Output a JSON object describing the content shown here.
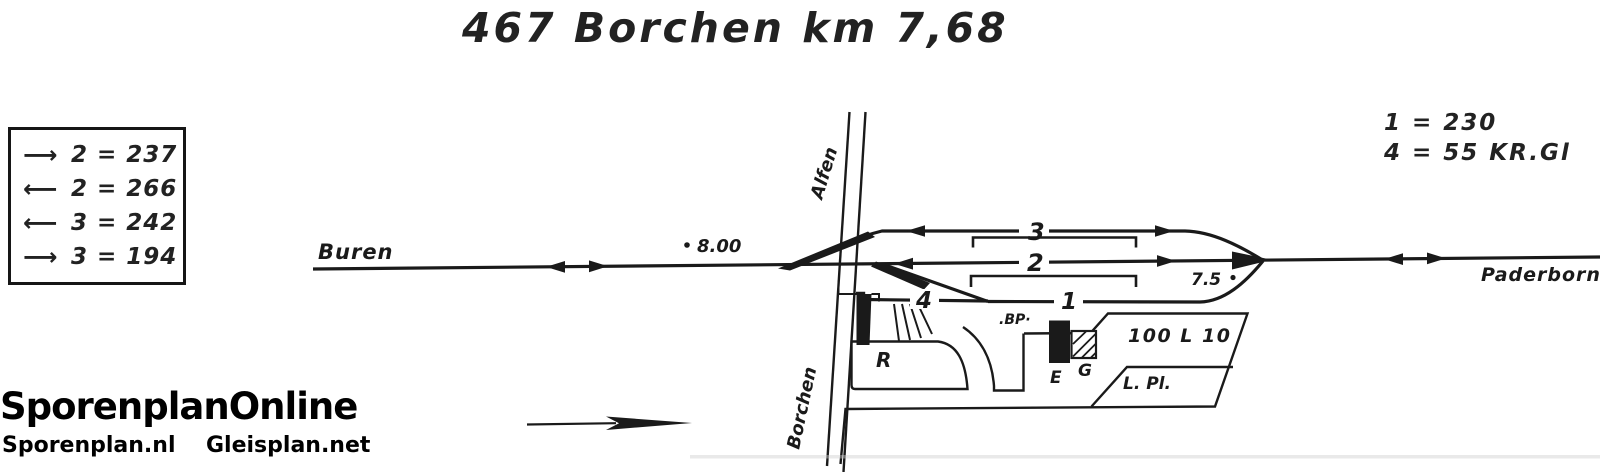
{
  "title": "467 Borchen km 7,68",
  "legend": {
    "rows": [
      {
        "arrow": "⟶",
        "label": "2 = 237"
      },
      {
        "arrow": "⟵",
        "label": "2 = 266"
      },
      {
        "arrow": "⟵",
        "label": "3 = 242"
      },
      {
        "arrow": "⟶",
        "label": "3 = 194"
      }
    ]
  },
  "notes": {
    "line1": "1 = 230",
    "line2": "4 = 55 KR.Gl"
  },
  "diagram": {
    "direction_west": "Buren",
    "direction_east": "Paderborn",
    "road_north": "Alfen",
    "road_south": "Borchen",
    "km_west": "8.00",
    "km_east": "7.5",
    "track_1": "1",
    "track_2": "2",
    "track_3": "3",
    "track_4": "4",
    "ramp_label": "R",
    "station_building_label": "E",
    "goods_shed_label": "G",
    "bp_label": ".BP·",
    "loading_track_label": "100 L 10",
    "loading_place_label": "L. Pl."
  },
  "footer": {
    "logo": "SporenplanOnline",
    "site_left": "Sporenplan.nl",
    "site_right": "Gleisplan.net"
  }
}
